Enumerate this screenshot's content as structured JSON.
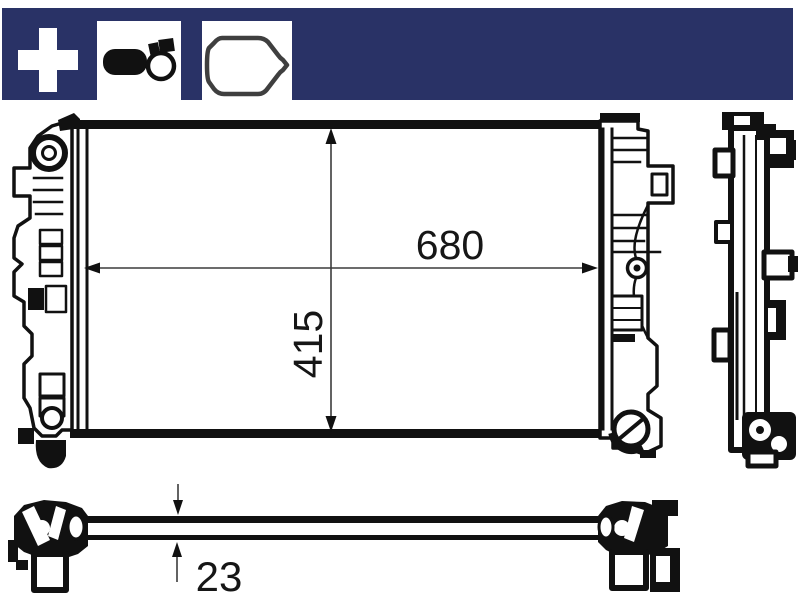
{
  "header": {
    "background_color": "#293266",
    "icon_box_color": "#ffffff",
    "icons": [
      {
        "name": "plus-icon"
      },
      {
        "name": "expansion-tank-clamp-icon"
      },
      {
        "name": "gasket-seal-outline-icon"
      }
    ]
  },
  "drawing": {
    "colors": {
      "line": "#111111",
      "dimension_line": "#3c3c3c",
      "background": "#ffffff"
    },
    "dimensions": {
      "width": "680",
      "core_height": "415",
      "thickness": "23"
    }
  }
}
